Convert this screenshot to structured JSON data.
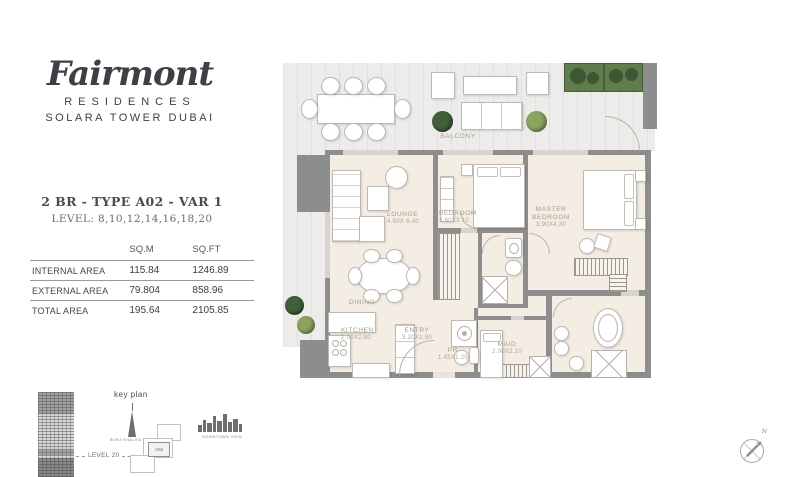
{
  "brand": {
    "name": "Fairmont",
    "residences": "RESIDENCES",
    "tower": "SOLARA TOWER DUBAI"
  },
  "unit": {
    "title": "2 BR - TYPE A02 - VAR 1",
    "levels": "LEVEL: 8,10,12,14,16,18,20"
  },
  "area_table": {
    "col_sqm": "SQ.M",
    "col_sqft": "SQ.FT",
    "rows": [
      {
        "label": "INTERNAL AREA",
        "sqm": "115.84",
        "sqft": "1246.89"
      },
      {
        "label": "EXTERNAL AREA",
        "sqm": "79.804",
        "sqft": "858.96"
      },
      {
        "label": "TOTAL AREA",
        "sqm": "195.64",
        "sqft": "2105.85"
      }
    ]
  },
  "key_plan": {
    "title": "key plan",
    "level": "LEVEL 20",
    "burj_view": "BURJ KHALIFA VIEW",
    "downtown_view": "DOWNTOWN VIEW",
    "unit": "A02"
  },
  "plan": {
    "balcony": "BALCONY",
    "lounge": {
      "name": "LOUNGE",
      "dims": "4.60X 6.40"
    },
    "bedroom": {
      "name": "BEDROOM",
      "dims": "3.60X3.10"
    },
    "master": {
      "name": "MASTER BEDROOM",
      "dims": "3.90X4.30"
    },
    "dining": "DINING",
    "kitchen": {
      "name": "KITCHEN",
      "dims": "2.90X2.80"
    },
    "entry": {
      "name": "ENTRY",
      "dims": "3.20X1.80"
    },
    "pr": {
      "name": "PR",
      "dims": "1.45X1.25"
    },
    "maid": {
      "name": "MAID",
      "dims": "2.00X2.10"
    },
    "compass_n": "N"
  },
  "colors": {
    "wall": "#8d8d8d",
    "floor": "#f4ede3",
    "deck": "#edecea",
    "plant_dark": "#41603a",
    "plant_light": "#8aa35f",
    "label": "#a49c8f"
  }
}
